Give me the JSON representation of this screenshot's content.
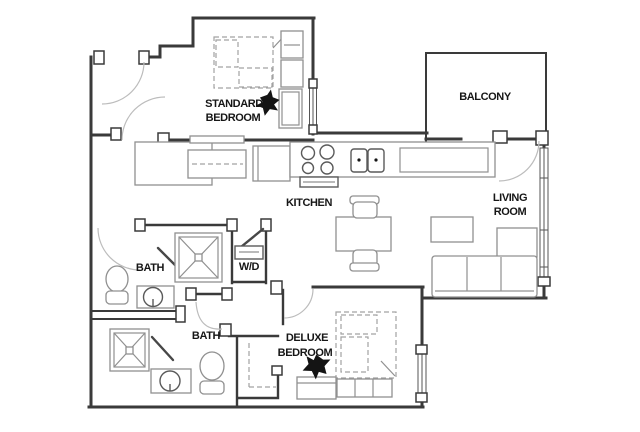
{
  "floor_plan": {
    "rooms": {
      "standard_bedroom": {
        "line1": "STANDARD",
        "line2": "BEDROOM"
      },
      "balcony": {
        "line1": "BALCONY"
      },
      "kitchen": {
        "line1": "KITCHEN"
      },
      "living_room": {
        "line1": "LIVING",
        "line2": "ROOM"
      },
      "bath_upper": {
        "line1": "BATH"
      },
      "laundry": {
        "line1": "W/D"
      },
      "bath_lower": {
        "line1": "BATH"
      },
      "deluxe_bedroom": {
        "line1": "DELUXE",
        "line2": "BEDROOM"
      }
    },
    "colors": {
      "wall": "#3a3a3a",
      "fixture": "#909090",
      "dashed": "#a2a2a2",
      "arc": "#bcbcbc",
      "icon": "#141414",
      "label": "#161616",
      "background": "#ffffff"
    }
  }
}
